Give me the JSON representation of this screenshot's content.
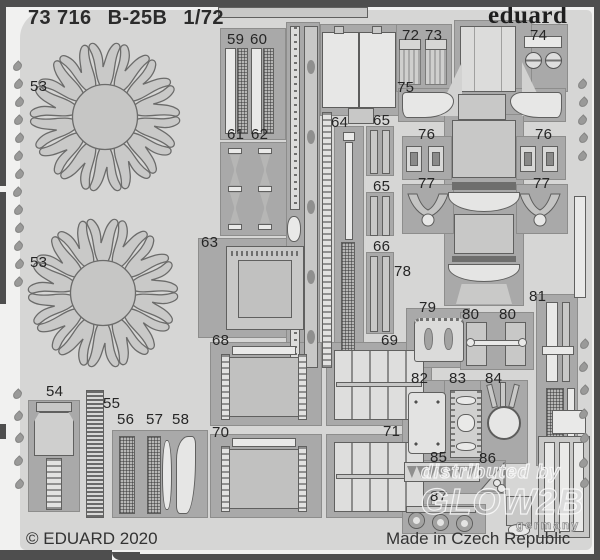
{
  "header": {
    "catalog_number": "73 716",
    "kit_name": "B-25B",
    "scale": "1/72",
    "brand_logo": "eduard"
  },
  "footer": {
    "copyright": "© EDUARD 2020",
    "origin": "Made in Czech Republic"
  },
  "watermark": {
    "line1": "distributed by",
    "line2": "GLOW2B",
    "line3": "germany"
  },
  "colors": {
    "frame": "#4e4e4e",
    "margin": "#f1f1f0",
    "fret_sheet": "#d6d6d5",
    "cutout": "#a9a9a9",
    "part_mid": "#c8c8c7",
    "part_light": "#e9e9e8",
    "outline": "#60605f",
    "label_text": "#262626"
  },
  "parts": [
    {
      "label": "53",
      "x": 30,
      "y": 78
    },
    {
      "label": "53",
      "x": 30,
      "y": 254
    },
    {
      "label": "54",
      "x": 46,
      "y": 383
    },
    {
      "label": "55",
      "x": 103,
      "y": 395
    },
    {
      "label": "56",
      "x": 117,
      "y": 411
    },
    {
      "label": "57",
      "x": 146,
      "y": 411
    },
    {
      "label": "58",
      "x": 172,
      "y": 411
    },
    {
      "label": "59",
      "x": 227,
      "y": 31
    },
    {
      "label": "60",
      "x": 250,
      "y": 31
    },
    {
      "label": "61",
      "x": 227,
      "y": 126
    },
    {
      "label": "62",
      "x": 251,
      "y": 126
    },
    {
      "label": "63",
      "x": 201,
      "y": 234
    },
    {
      "label": "64",
      "x": 331,
      "y": 114
    },
    {
      "label": "65",
      "x": 373,
      "y": 112
    },
    {
      "label": "65",
      "x": 373,
      "y": 178
    },
    {
      "label": "66",
      "x": 373,
      "y": 238
    },
    {
      "label": "68",
      "x": 212,
      "y": 332
    },
    {
      "label": "69",
      "x": 381,
      "y": 332
    },
    {
      "label": "70",
      "x": 212,
      "y": 424
    },
    {
      "label": "71",
      "x": 383,
      "y": 423
    },
    {
      "label": "72",
      "x": 402,
      "y": 27
    },
    {
      "label": "73",
      "x": 425,
      "y": 27
    },
    {
      "label": "74",
      "x": 530,
      "y": 27
    },
    {
      "label": "75",
      "x": 397,
      "y": 79
    },
    {
      "label": "76",
      "x": 418,
      "y": 126
    },
    {
      "label": "76",
      "x": 535,
      "y": 126
    },
    {
      "label": "77",
      "x": 418,
      "y": 175
    },
    {
      "label": "77",
      "x": 533,
      "y": 175
    },
    {
      "label": "78",
      "x": 394,
      "y": 263
    },
    {
      "label": "79",
      "x": 419,
      "y": 299
    },
    {
      "label": "80",
      "x": 462,
      "y": 306
    },
    {
      "label": "80",
      "x": 499,
      "y": 306
    },
    {
      "label": "81",
      "x": 529,
      "y": 288
    },
    {
      "label": "82",
      "x": 411,
      "y": 370
    },
    {
      "label": "83",
      "x": 449,
      "y": 370
    },
    {
      "label": "84",
      "x": 485,
      "y": 370
    },
    {
      "label": "85",
      "x": 430,
      "y": 449
    },
    {
      "label": "86",
      "x": 479,
      "y": 450
    },
    {
      "label": "87",
      "x": 430,
      "y": 488
    }
  ]
}
